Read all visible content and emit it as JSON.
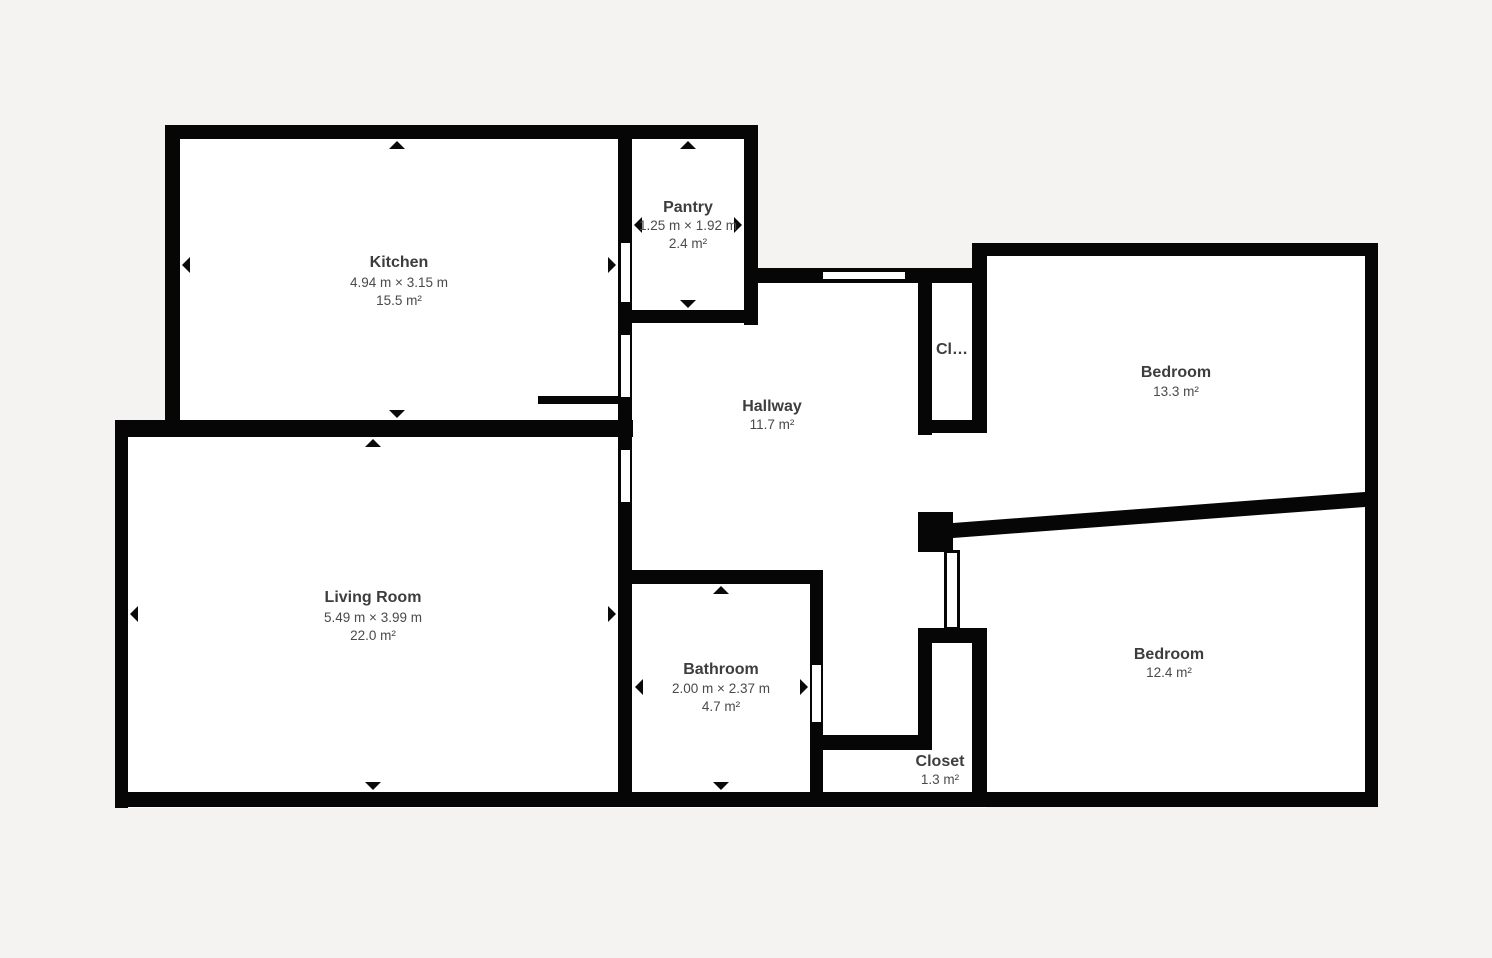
{
  "floorplan": {
    "title": "Apartment floor plan",
    "colors": {
      "background": "#f4f3f1",
      "wall": "#060606",
      "floor": "#ffffff",
      "room_name_text": "#3d3d3d",
      "dimension_text": "#4a4a4a"
    },
    "rooms": {
      "kitchen": {
        "name": "Kitchen",
        "dimensions": "4.94 m × 3.15 m",
        "area": "15.5 m²"
      },
      "pantry": {
        "name": "Pantry",
        "dimensions": "1.25 m × 1.92 m",
        "area": "2.4 m²"
      },
      "hallway": {
        "name": "Hallway",
        "area": "11.7 m²"
      },
      "closet_small": {
        "name": "Cl…"
      },
      "bedroom_top": {
        "name": "Bedroom",
        "area": "13.3 m²"
      },
      "bedroom_bottom": {
        "name": "Bedroom",
        "area": "12.4 m²"
      },
      "living_room": {
        "name": "Living Room",
        "dimensions": "5.49 m × 3.99 m",
        "area": "22.0 m²"
      },
      "bathroom": {
        "name": "Bathroom",
        "dimensions": "2.00 m × 2.37 m",
        "area": "4.7 m²"
      },
      "closet": {
        "name": "Closet",
        "area": "1.3 m²"
      }
    }
  }
}
